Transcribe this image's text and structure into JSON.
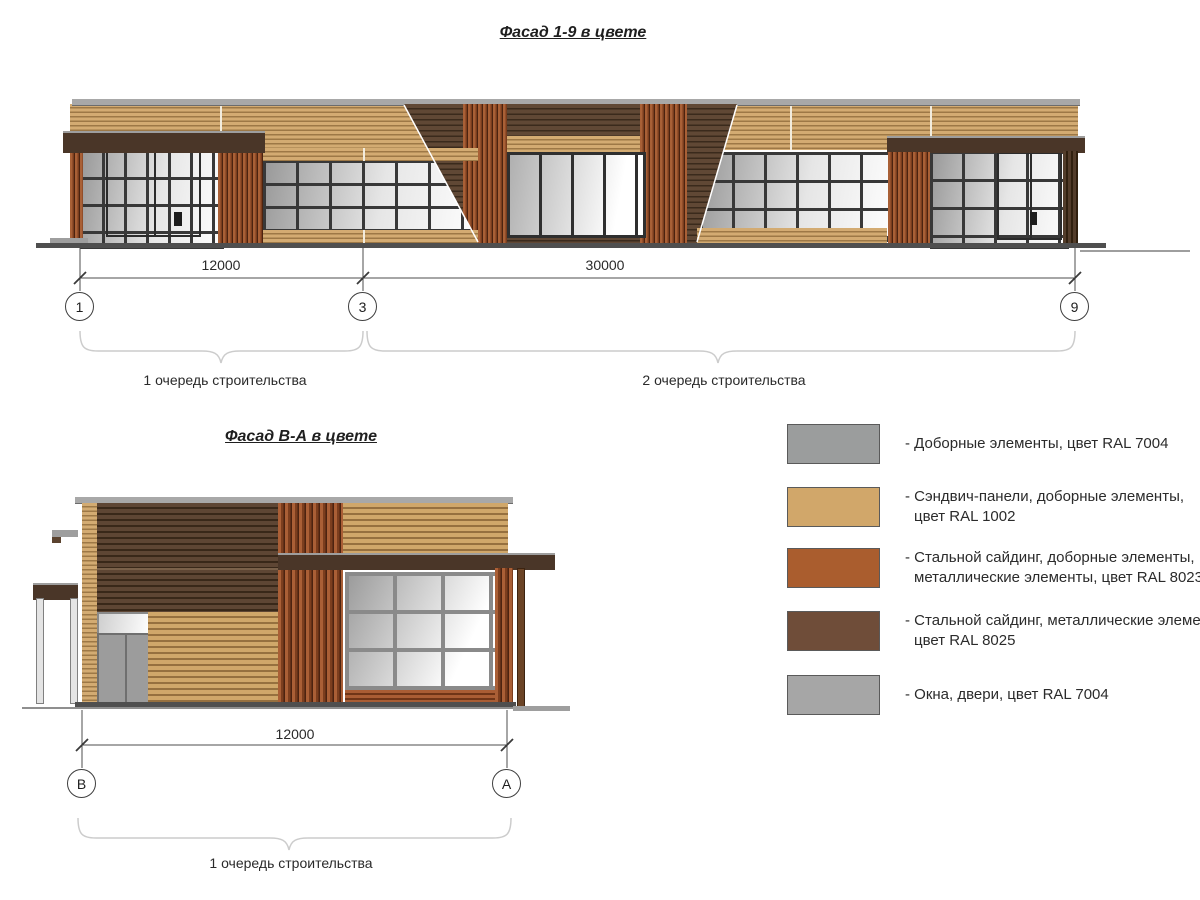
{
  "facade_top": {
    "title": "Фасад 1-9 в цвете",
    "dim_left": "12000",
    "dim_right": "30000",
    "axis_left": "1",
    "axis_mid": "3",
    "axis_right": "9",
    "phase1": "1 очередь строительства",
    "phase2": "2 очередь строительства"
  },
  "facade_side": {
    "title": "Фасад В-А в цвете",
    "dim": "12000",
    "axis_left": "В",
    "axis_right": "А",
    "phase1": "1 очередь строительства"
  },
  "legend": {
    "items": [
      {
        "color": "#9b9d9d",
        "line1": "- Доборные элементы, цвет RAL 7004",
        "line2": ""
      },
      {
        "color": "#d1a76a",
        "line1": "- Сэндвич-панели, доборные элементы,",
        "line2": "цвет RAL 1002"
      },
      {
        "color": "#aa5d2e",
        "line1": "- Стальной сайдинг, доборные элементы,",
        "line2": "металлические элементы, цвет RAL 8023"
      },
      {
        "color": "#6f4d39",
        "line1": "- Стальной сайдинг, металлические элементы,",
        "line2": "цвет RAL 8025"
      },
      {
        "color": "#a6a6a6",
        "line1": "- Окна, двери, цвет RAL 7004",
        "line2": ""
      }
    ]
  },
  "materials": {
    "sandwich_panel_tan": "#d1a76a",
    "steel_siding_orange": "#aa5d2e",
    "steel_siding_dark_brown": "#6f4d39",
    "trim_gray": "#9b9d9d",
    "windows_doors_gray": "#a6a6a6"
  }
}
